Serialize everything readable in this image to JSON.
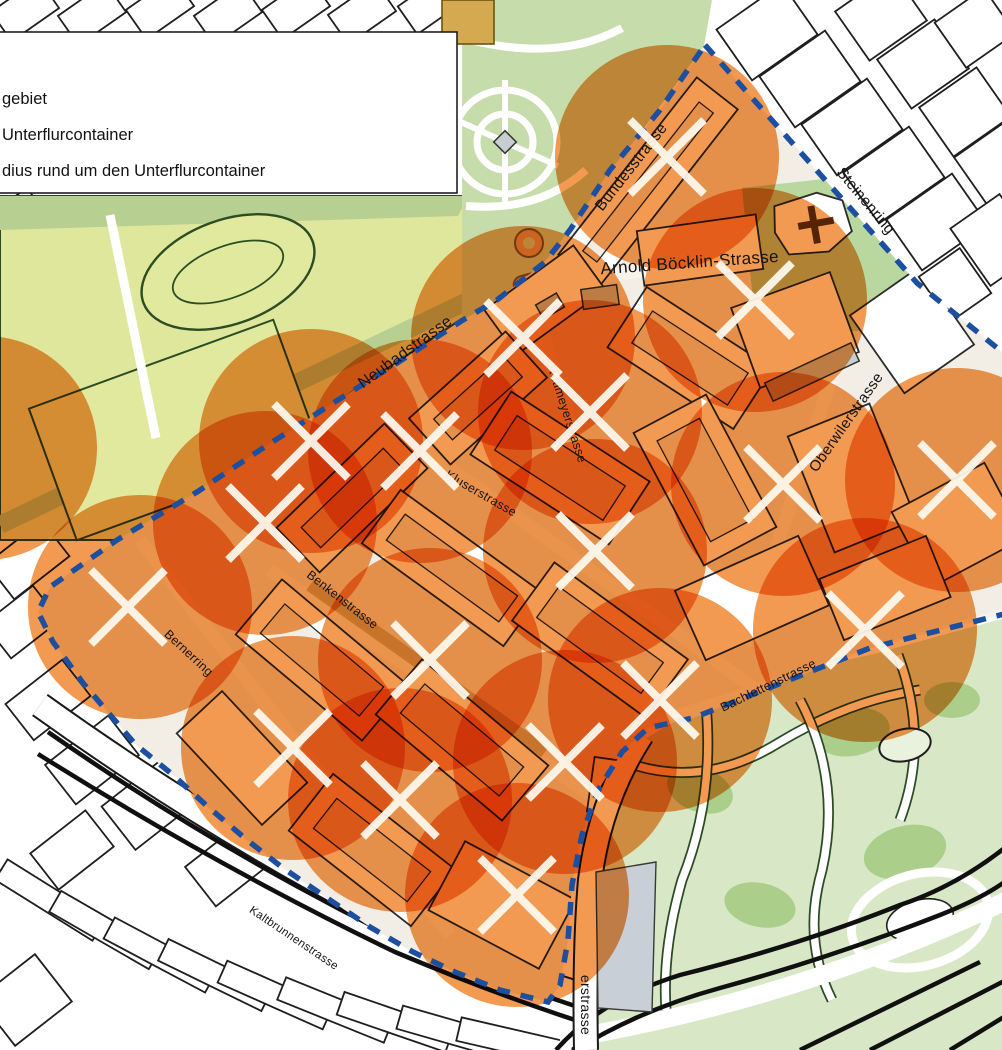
{
  "title": "Unterflurcontainer Pilotgebiet Karte",
  "legend": {
    "items": [
      {
        "label": "gebiet"
      },
      {
        "label": "Unterflurcontainer"
      },
      {
        "label": "dius rund um den Unterflurcontainer"
      }
    ]
  },
  "map": {
    "street_labels": [
      {
        "name": "Bundesstrasse",
        "x": 635,
        "y": 170,
        "rot": -52,
        "size": 15.5
      },
      {
        "name": "Steinenring",
        "x": 862,
        "y": 204,
        "rot": 50,
        "size": 15.5
      },
      {
        "name": "Arnold Böcklin-Strasse",
        "x": 690,
        "y": 268,
        "rot": -4,
        "size": 17
      },
      {
        "name": "Neubadstrasse",
        "x": 408,
        "y": 356,
        "rot": -36,
        "size": 16
      },
      {
        "name": "Rütimeyerstrasse",
        "x": 563,
        "y": 415,
        "rot": 72,
        "size": 12.5
      },
      {
        "name": "Oberwilerstrasse",
        "x": 850,
        "y": 425,
        "rot": -55,
        "size": 15
      },
      {
        "name": "Kluserstrasse",
        "x": 479,
        "y": 497,
        "rot": 30,
        "size": 12.5
      },
      {
        "name": "Benkenstrasse",
        "x": 340,
        "y": 603,
        "rot": 38,
        "size": 12.5
      },
      {
        "name": "Bernerring",
        "x": 186,
        "y": 656,
        "rot": 43,
        "size": 12.5
      },
      {
        "name": "Bachlettenstrasse",
        "x": 770,
        "y": 689,
        "rot": -26,
        "size": 12.5
      },
      {
        "name": "Kaltbrunnenstrasse",
        "x": 292,
        "y": 941,
        "rot": 34,
        "size": 11.5
      },
      {
        "name": "erstrasse",
        "x": 581,
        "y": 1005,
        "rot": 90,
        "size": 14
      }
    ],
    "container_markers": {
      "symbol": "x-cross",
      "color": "#FDFAF0",
      "positions": [
        {
          "x": 667,
          "y": 157
        },
        {
          "x": 755,
          "y": 300
        },
        {
          "x": 523,
          "y": 338
        },
        {
          "x": 590,
          "y": 412
        },
        {
          "x": 311,
          "y": 441
        },
        {
          "x": 420,
          "y": 451
        },
        {
          "x": 783,
          "y": 484
        },
        {
          "x": 957,
          "y": 480
        },
        {
          "x": 265,
          "y": 523
        },
        {
          "x": 595,
          "y": 551
        },
        {
          "x": 128,
          "y": 607
        },
        {
          "x": 430,
          "y": 660
        },
        {
          "x": 865,
          "y": 630
        },
        {
          "x": 660,
          "y": 700
        },
        {
          "x": 293,
          "y": 748
        },
        {
          "x": 400,
          "y": 800
        },
        {
          "x": 565,
          "y": 762
        },
        {
          "x": 517,
          "y": 895
        }
      ]
    },
    "radius_circles": {
      "color": "#F29A52",
      "radius": 112,
      "centers": [
        {
          "x": 667,
          "y": 157
        },
        {
          "x": 755,
          "y": 300
        },
        {
          "x": 523,
          "y": 338
        },
        {
          "x": 590,
          "y": 412
        },
        {
          "x": 311,
          "y": 441
        },
        {
          "x": 420,
          "y": 451
        },
        {
          "x": 783,
          "y": 484
        },
        {
          "x": 957,
          "y": 480
        },
        {
          "x": 265,
          "y": 523
        },
        {
          "x": 595,
          "y": 551
        },
        {
          "x": 140,
          "y": 607
        },
        {
          "x": 430,
          "y": 660
        },
        {
          "x": 865,
          "y": 630
        },
        {
          "x": 660,
          "y": 700
        },
        {
          "x": 293,
          "y": 748
        },
        {
          "x": 400,
          "y": 800
        },
        {
          "x": 565,
          "y": 762
        },
        {
          "x": 517,
          "y": 895
        },
        {
          "x": -15,
          "y": 448
        }
      ]
    },
    "pilot_area_boundary": {
      "color": "#1C4FA0",
      "style": "dashed",
      "points": [
        [
          705,
          45
        ],
        [
          917,
          283
        ],
        [
          1012,
          360
        ],
        [
          1012,
          612
        ],
        [
          870,
          648
        ],
        [
          693,
          718
        ],
        [
          648,
          728
        ],
        [
          622,
          752
        ],
        [
          598,
          790
        ],
        [
          582,
          835
        ],
        [
          572,
          885
        ],
        [
          568,
          940
        ],
        [
          560,
          985
        ],
        [
          548,
          1002
        ],
        [
          500,
          990
        ],
        [
          455,
          972
        ],
        [
          413,
          952
        ],
        [
          370,
          927
        ],
        [
          330,
          900
        ],
        [
          283,
          868
        ],
        [
          247,
          840
        ],
        [
          207,
          806
        ],
        [
          173,
          775
        ],
        [
          135,
          744
        ],
        [
          83,
          683
        ],
        [
          53,
          642
        ],
        [
          38,
          612
        ],
        [
          50,
          587
        ],
        [
          117,
          540
        ],
        [
          197,
          492
        ],
        [
          263,
          448
        ],
        [
          330,
          405
        ],
        [
          397,
          363
        ],
        [
          463,
          320
        ],
        [
          497,
          300
        ],
        [
          545,
          262
        ],
        [
          570,
          230
        ],
        [
          610,
          170
        ],
        [
          660,
          110
        ],
        [
          705,
          45
        ]
      ]
    },
    "colors": {
      "radius_orange": "#F29A52",
      "boundary_blue": "#1C4FA0",
      "park_green": "#C6DCAA",
      "sports_field_green": "#DFE79D",
      "band_green": "#B7CF90",
      "park_light_green": "#D8E8C6",
      "park_dark_patch": "#ABCF8B",
      "gray_building": "#C7CDD3",
      "inside_ground": "#F2EEE6",
      "marker_white": "#FDFAF0"
    }
  }
}
